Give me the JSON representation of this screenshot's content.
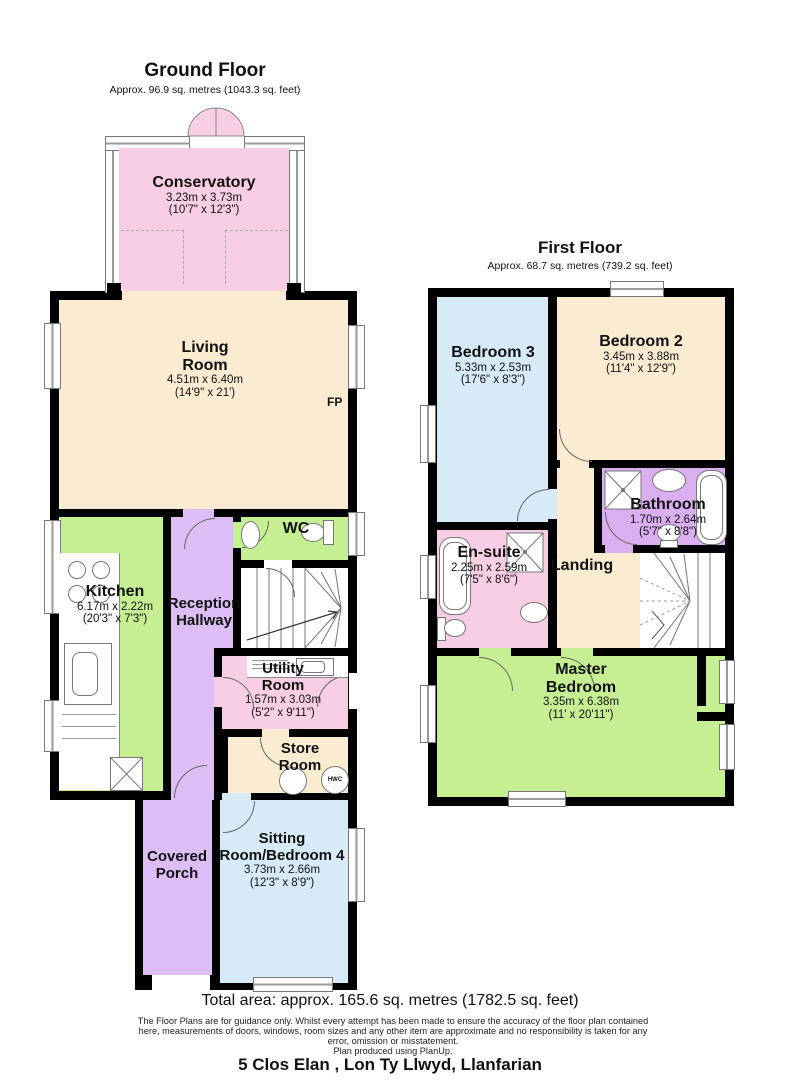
{
  "ground_floor": {
    "title": "Ground Floor",
    "area": "Approx. 96.9 sq. metres (1043.3 sq. feet)",
    "rooms": {
      "conservatory": {
        "name": "Conservatory",
        "metric": "3.23m x 3.73m",
        "imperial": "(10'7\" x 12'3\")"
      },
      "living_room": {
        "name": "Living Room",
        "metric": "4.51m x 6.40m",
        "imperial": "(14'9\" x 21')"
      },
      "kitchen": {
        "name": "Kitchen",
        "metric": "6.17m x 2.22m",
        "imperial": "(20'3\" x 7'3\")"
      },
      "reception_hallway": {
        "name": "Reception Hallway"
      },
      "wc": {
        "name": "WC"
      },
      "utility_room": {
        "name": "Utility Room",
        "metric": "1.57m x 3.03m",
        "imperial": "(5'2\" x 9'11\")"
      },
      "store_room": {
        "name": "Store Room"
      },
      "covered_porch": {
        "name": "Covered Porch"
      },
      "sitting_room": {
        "name": "Sitting Room/Bedroom 4",
        "metric": "3.73m x 2.66m",
        "imperial": "(12'3\" x 8'9\")"
      }
    },
    "annotations": {
      "fireplace": "FP",
      "hot_water_cylinder": "HWC"
    }
  },
  "first_floor": {
    "title": "First Floor",
    "area": "Approx. 68.7 sq. metres (739.2 sq. feet)",
    "rooms": {
      "bedroom_3": {
        "name": "Bedroom 3",
        "metric": "5.33m x 2.53m",
        "imperial": "(17'6\" x 8'3\")"
      },
      "bedroom_2": {
        "name": "Bedroom 2",
        "metric": "3.45m x 3.88m",
        "imperial": "(11'4\" x 12'9\")"
      },
      "bathroom": {
        "name": "Bathroom",
        "metric": "1.70m x 2.64m",
        "imperial": "(5'7\" x 8'8\")"
      },
      "en_suite": {
        "name": "En-suite",
        "metric": "2.25m x 2.59m",
        "imperial": "(7'5\" x 8'6\")"
      },
      "landing": {
        "name": "Landing"
      },
      "master_bedroom": {
        "name": "Master Bedroom",
        "metric": "3.35m x 6.38m",
        "imperial": "(11' x 20'11\")"
      }
    }
  },
  "footer": {
    "total_area": "Total area: approx. 165.6 sq. metres (1782.5 sq. feet)",
    "disclaimer": [
      "The Floor Plans are for guidance only. Whilst every attempt has been made to ensure the accuracy of the floor plan contained",
      "here, measurements of doors, windows, room sizes and any other item are approximate and no responsibility is taken for any",
      "error, omission or misstatement.",
      "Plan produced using PlanUp."
    ],
    "address": "5 Clos Elan , Lon Ty Llwyd, Llanfarian"
  },
  "colors": {
    "cream": "#FBEBD1",
    "green": "#C6EE93",
    "purple": "#DCBDF4",
    "bath_purple": "#D9AFF0",
    "pink": "#F8CEE4",
    "blue": "#D6EAF7",
    "wall": "#000000"
  }
}
